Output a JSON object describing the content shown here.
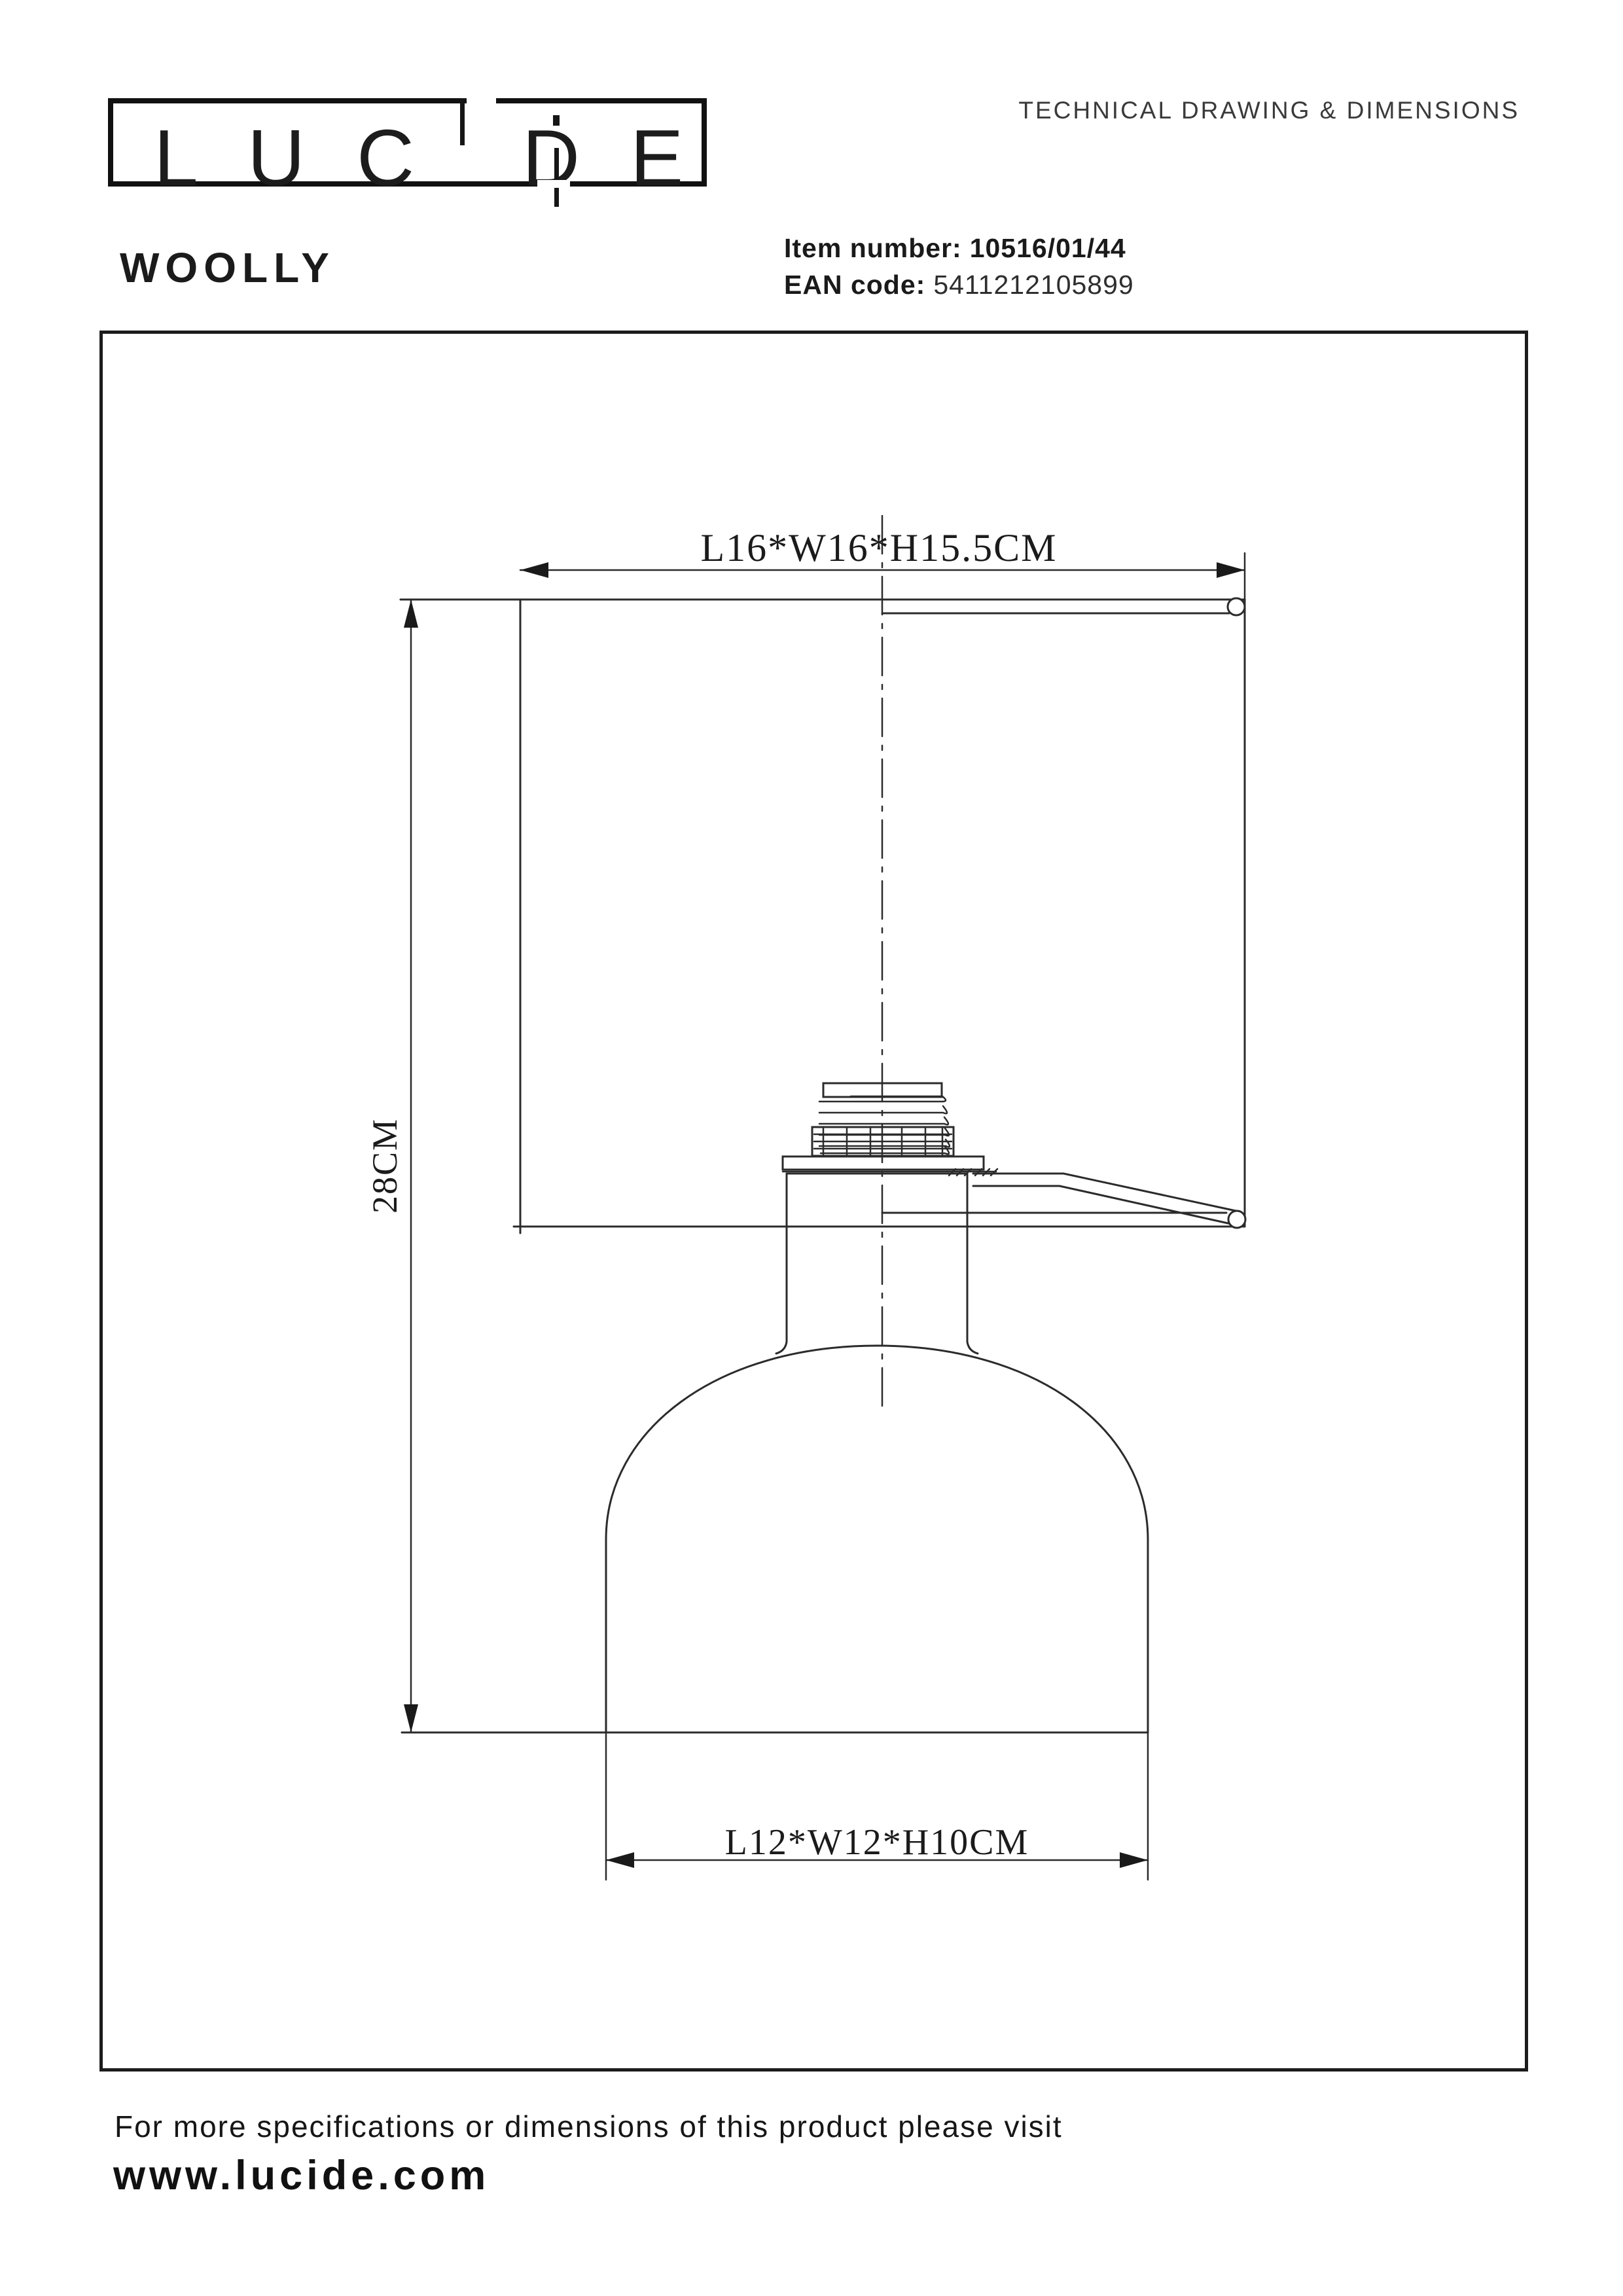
{
  "header": {
    "logo": {
      "letters": [
        "L",
        "U",
        "C",
        "D",
        "E"
      ],
      "word": "LUCIDE"
    },
    "doc_title": "TECHNICAL DRAWING & DIMENSIONS",
    "product_name": "WOOLLY",
    "item_label": "Item number:",
    "item_value": "10516/01/44",
    "ean_label": "EAN code:",
    "ean_value": "5411212105899"
  },
  "drawing": {
    "dim_top": "L16*W16*H15.5CM",
    "dim_left": "28CM",
    "dim_bottom": "L12*W12*H10CM"
  },
  "footer": {
    "line1": "For more specifications or dimensions of this product please visit",
    "line2": "www.lucide.com"
  },
  "colors": {
    "ink": "#1a1a1a",
    "line": "#2b2b2b",
    "paper": "#ffffff"
  }
}
